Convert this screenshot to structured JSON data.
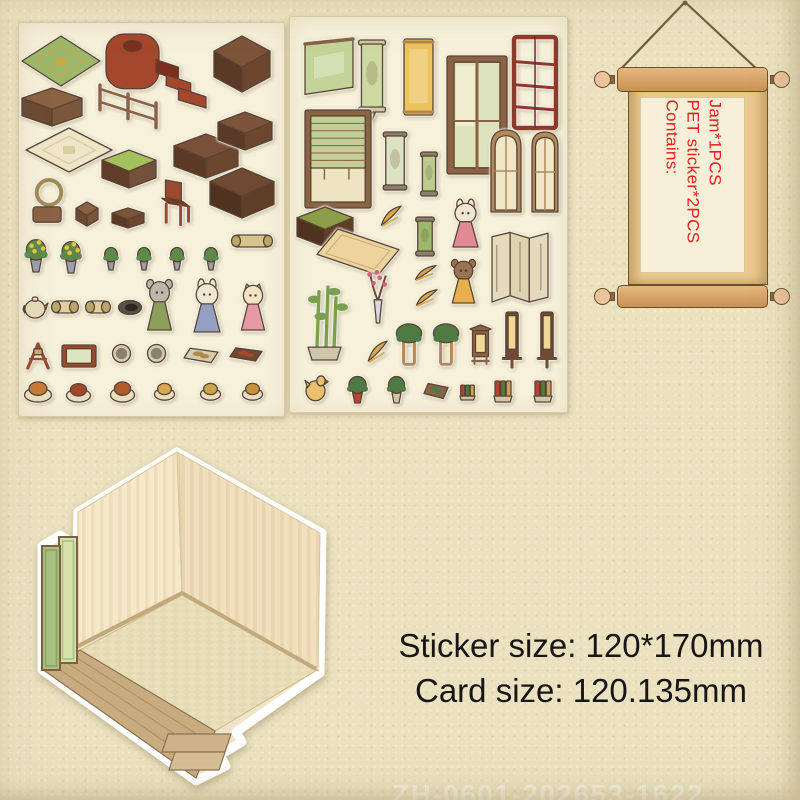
{
  "background": {
    "paper": "#ebe1bf",
    "sheet": "#f7f1da",
    "outline": "#5a4330"
  },
  "scroll": {
    "lines": [
      "Contains:",
      "PET sticker*2PCS",
      "Jam*1PCS"
    ],
    "text_color": "#e3201b",
    "rod_color": "#d8a76a",
    "body_color": "#eac88e",
    "panel_color": "#f7efd7"
  },
  "size_text": {
    "line1": "Sticker size: 120*170mm",
    "line2": "Card size: 120.135mm",
    "color": "#161616"
  },
  "watermark": "ZH-0601-202653-1622",
  "room_card": {
    "wall_color": "#f5e8cb",
    "floor_color": "#ebe0bd",
    "porch_color": "#c8ab7e",
    "screen_color": "#a9c083"
  },
  "sheets": [
    {
      "name": "sticker-sheet-1",
      "stickers": [
        {
          "n": "rug-green-diamond",
          "t": "rug",
          "x": 2,
          "y": 12,
          "w": 80,
          "h": 52,
          "c": [
            "#9cb86b",
            "#c8a84b"
          ]
        },
        {
          "n": "bed-stairs",
          "t": "bed",
          "x": 86,
          "y": 10,
          "w": 102,
          "h": 76,
          "c": [
            "#a5472c",
            "#7d2f1d"
          ]
        },
        {
          "n": "cabinet",
          "t": "box",
          "x": 194,
          "y": 12,
          "w": 58,
          "h": 58,
          "c": [
            "#7d543a",
            "#5a3a26",
            "#6d462e"
          ]
        },
        {
          "n": "wall-shelf",
          "t": "box",
          "x": 2,
          "y": 64,
          "w": 62,
          "h": 40,
          "c": [
            "#8a6244",
            "#6b4a32",
            "#7a563c"
          ]
        },
        {
          "n": "fence-railing",
          "t": "fence",
          "x": 78,
          "y": 52,
          "w": 62,
          "h": 56,
          "c": [
            "#8a6244"
          ]
        },
        {
          "n": "rug-cream-diamond",
          "t": "rug",
          "x": 6,
          "y": 104,
          "w": 88,
          "h": 46,
          "c": [
            "#efe6c8",
            "#d9cda4"
          ]
        },
        {
          "n": "bench-green-cushion",
          "t": "box",
          "x": 82,
          "y": 126,
          "w": 56,
          "h": 40,
          "c": [
            "#a2c05c",
            "#5f3d28",
            "#75503a"
          ]
        },
        {
          "n": "desk",
          "t": "box",
          "x": 154,
          "y": 110,
          "w": 66,
          "h": 46,
          "c": [
            "#7a5138",
            "#5a3a26",
            "#6d462e"
          ]
        },
        {
          "n": "tea-table",
          "t": "box",
          "x": 198,
          "y": 88,
          "w": 56,
          "h": 40,
          "c": [
            "#7d543a",
            "#5a3a26",
            "#6d462e"
          ]
        },
        {
          "n": "basket-chair",
          "t": "basket",
          "x": 12,
          "y": 156,
          "w": 36,
          "h": 48,
          "c": [
            "#a08a56",
            "#8a6244"
          ]
        },
        {
          "n": "stool",
          "t": "box",
          "x": 56,
          "y": 178,
          "w": 24,
          "h": 26,
          "c": [
            "#8a6244",
            "#6b4a32",
            "#7a563c"
          ]
        },
        {
          "n": "foot-stool",
          "t": "box",
          "x": 92,
          "y": 184,
          "w": 34,
          "h": 22,
          "c": [
            "#7d543a",
            "#5a3a26",
            "#6d462e"
          ]
        },
        {
          "n": "armchair",
          "t": "chair",
          "x": 140,
          "y": 156,
          "w": 36,
          "h": 48,
          "c": [
            "#9c4a2e",
            "#7d3a22"
          ]
        },
        {
          "n": "daybed-bench",
          "t": "box",
          "x": 190,
          "y": 144,
          "w": 66,
          "h": 52,
          "c": [
            "#6f4931",
            "#4f3320",
            "#5f3e27"
          ]
        },
        {
          "n": "rolled-mat",
          "t": "roll",
          "x": 212,
          "y": 208,
          "w": 42,
          "h": 20,
          "c": [
            "#d6c48e",
            "#b9a86b"
          ]
        },
        {
          "n": "flower-arrangement-1",
          "t": "flower",
          "x": 2,
          "y": 216,
          "w": 30,
          "h": 34,
          "c": [
            "#5d8a4a",
            "#98a0ad",
            "#e8c33c"
          ]
        },
        {
          "n": "flower-arrangement-2",
          "t": "flower",
          "x": 38,
          "y": 218,
          "w": 28,
          "h": 33,
          "c": [
            "#5d8a4a",
            "#98a0ad",
            "#e8c33c"
          ]
        },
        {
          "n": "potted-plant-1",
          "t": "plant",
          "x": 82,
          "y": 224,
          "w": 20,
          "h": 24,
          "c": [
            "#5d8a4a",
            "#9aa0a8"
          ]
        },
        {
          "n": "potted-plant-2",
          "t": "plant",
          "x": 115,
          "y": 224,
          "w": 20,
          "h": 24,
          "c": [
            "#5d8a4a",
            "#9aa0a8"
          ]
        },
        {
          "n": "potted-plant-3",
          "t": "plant",
          "x": 148,
          "y": 224,
          "w": 20,
          "h": 24,
          "c": [
            "#5d8a4a",
            "#9aa0a8"
          ]
        },
        {
          "n": "potted-plant-4",
          "t": "plant",
          "x": 182,
          "y": 224,
          "w": 20,
          "h": 24,
          "c": [
            "#5d8a4a",
            "#9aa0a8"
          ]
        },
        {
          "n": "censer",
          "t": "teapot",
          "x": 2,
          "y": 268,
          "w": 28,
          "h": 30,
          "c": [
            "#e5dabb",
            "#8a6244"
          ]
        },
        {
          "n": "scroll-bundle-1",
          "t": "roll",
          "x": 32,
          "y": 274,
          "w": 28,
          "h": 20,
          "c": [
            "#e3cf9c",
            "#b9a86b"
          ]
        },
        {
          "n": "scroll-bundle-2",
          "t": "roll",
          "x": 66,
          "y": 274,
          "w": 26,
          "h": 20,
          "c": [
            "#e3cf9c",
            "#b9a86b"
          ]
        },
        {
          "n": "ink-dish",
          "t": "inkstone",
          "x": 98,
          "y": 276,
          "w": 26,
          "h": 17,
          "c": [
            "#57504a",
            "#2e2822"
          ]
        },
        {
          "n": "mouse-figure",
          "t": "char-round",
          "x": 124,
          "y": 256,
          "w": 33,
          "h": 52,
          "c": [
            "#bdb7aa",
            "#8aa05c"
          ]
        },
        {
          "n": "rabbit-figure",
          "t": "char-long",
          "x": 170,
          "y": 258,
          "w": 36,
          "h": 52,
          "c": [
            "#f0e6d4",
            "#93a0c4"
          ]
        },
        {
          "n": "cat-figure",
          "t": "char-point",
          "x": 218,
          "y": 260,
          "w": 32,
          "h": 48,
          "c": [
            "#f2e3c4",
            "#e59aa4"
          ]
        },
        {
          "n": "wooden-stand",
          "t": "stand",
          "x": 4,
          "y": 318,
          "w": 30,
          "h": 30,
          "c": [
            "#9c4a2e",
            "#caa96f"
          ]
        },
        {
          "n": "framed-art",
          "t": "frame",
          "x": 42,
          "y": 320,
          "w": 36,
          "h": 26,
          "c": [
            "#9c4a2e",
            "#dce4c0"
          ]
        },
        {
          "n": "plate-1",
          "t": "plate",
          "x": 92,
          "y": 320,
          "w": 21,
          "h": 21,
          "c": [
            "#d5cbae",
            "#8a8070"
          ]
        },
        {
          "n": "plate-2",
          "t": "plate",
          "x": 127,
          "y": 320,
          "w": 21,
          "h": 21,
          "c": [
            "#d5cbae",
            "#8a8070"
          ]
        },
        {
          "n": "dim-sum-tray",
          "t": "tray",
          "x": 164,
          "y": 320,
          "w": 36,
          "h": 24,
          "c": [
            "#d5cbae",
            "#b08a4a"
          ]
        },
        {
          "n": "snack-tray",
          "t": "tray",
          "x": 210,
          "y": 320,
          "w": 34,
          "h": 22,
          "c": [
            "#6f4931",
            "#a5472c"
          ]
        },
        {
          "n": "dish-1",
          "t": "food",
          "x": 4,
          "y": 356,
          "w": 30,
          "h": 24,
          "c": [
            "#e8dfc2",
            "#c47a3a"
          ]
        },
        {
          "n": "dish-2",
          "t": "food",
          "x": 46,
          "y": 358,
          "w": 27,
          "h": 22,
          "c": [
            "#e8dfc2",
            "#a5472c"
          ]
        },
        {
          "n": "dish-3",
          "t": "food",
          "x": 90,
          "y": 356,
          "w": 27,
          "h": 24,
          "c": [
            "#e8dfc2",
            "#b05a2e"
          ]
        },
        {
          "n": "dish-4",
          "t": "food",
          "x": 134,
          "y": 358,
          "w": 23,
          "h": 20,
          "c": [
            "#e8dfc2",
            "#d8a94e"
          ]
        },
        {
          "n": "dish-5",
          "t": "food",
          "x": 180,
          "y": 358,
          "w": 23,
          "h": 20,
          "c": [
            "#e8dfc2",
            "#caa54b"
          ]
        },
        {
          "n": "dish-6",
          "t": "food",
          "x": 222,
          "y": 358,
          "w": 23,
          "h": 20,
          "c": [
            "#e8dfc2",
            "#c8913c"
          ]
        }
      ]
    },
    {
      "name": "sticker-sheet-2",
      "stickers": [
        {
          "n": "wall-flag-green",
          "t": "flag",
          "x": 14,
          "y": 21,
          "w": 50,
          "h": 60,
          "c": [
            "#8a6244",
            "#c2d498"
          ]
        },
        {
          "n": "wall-scroll-green",
          "t": "scrolltail",
          "x": 66,
          "y": 22,
          "w": 32,
          "h": 82,
          "c": [
            "#cfc5a8",
            "#cdd9a0"
          ]
        },
        {
          "n": "wall-banner-yellow",
          "t": "banner",
          "x": 113,
          "y": 19,
          "w": 31,
          "h": 82,
          "c": [
            "#b08a4a",
            "#ecc35f"
          ]
        },
        {
          "n": "window-curtains",
          "t": "window",
          "x": 156,
          "y": 38,
          "w": 62,
          "h": 120,
          "c": [
            "#8a6244",
            "#dde3bc",
            "#f6f0d8"
          ]
        },
        {
          "n": "display-shelf-red",
          "t": "shelfunit",
          "x": 223,
          "y": 16,
          "w": 44,
          "h": 96,
          "c": [
            "#8d3a2a",
            "#6f2b1d"
          ]
        },
        {
          "n": "window-blinds",
          "t": "blindwin",
          "x": 14,
          "y": 92,
          "w": 68,
          "h": 100,
          "c": [
            "#8a6244",
            "#c3cf96",
            "#ede4c2"
          ]
        },
        {
          "n": "hanging-scroll-art",
          "t": "scrollpic",
          "x": 91,
          "y": 114,
          "w": 28,
          "h": 62,
          "c": [
            "#8a8070",
            "#dce3c2"
          ]
        },
        {
          "n": "hanging-scroll-small",
          "t": "scrollpic",
          "x": 129,
          "y": 134,
          "w": 20,
          "h": 48,
          "c": [
            "#8a8070",
            "#b9cc8e"
          ]
        },
        {
          "n": "arched-door-1",
          "t": "door",
          "x": 200,
          "y": 112,
          "w": 32,
          "h": 84,
          "c": [
            "#b08a5a",
            "#f0e6c8"
          ]
        },
        {
          "n": "arched-door-2",
          "t": "door",
          "x": 241,
          "y": 114,
          "w": 28,
          "h": 82,
          "c": [
            "#b08a5a",
            "#f0e6c8"
          ]
        },
        {
          "n": "bench-low",
          "t": "box",
          "x": 6,
          "y": 189,
          "w": 58,
          "h": 42,
          "c": [
            "#8a9e4a",
            "#4f3320",
            "#5f3e27"
          ]
        },
        {
          "n": "leaf-spray-1",
          "t": "leaf",
          "x": 89,
          "y": 187,
          "w": 24,
          "h": 26,
          "c": [
            "#d8a94e"
          ]
        },
        {
          "n": "scroll-bamboo",
          "t": "scrollpic",
          "x": 124,
          "y": 199,
          "w": 22,
          "h": 43,
          "c": [
            "#8a8070",
            "#9cb86b"
          ]
        },
        {
          "n": "rabbit-girl-figure",
          "t": "char-long",
          "x": 158,
          "y": 184,
          "w": 35,
          "h": 47,
          "c": [
            "#f0e6d4",
            "#e08a96"
          ]
        },
        {
          "n": "floor-mat",
          "t": "mat",
          "x": 26,
          "y": 211,
          "w": 84,
          "h": 48,
          "c": [
            "#ecd49c"
          ]
        },
        {
          "n": "folding-screen",
          "t": "screen3",
          "x": 201,
          "y": 214,
          "w": 58,
          "h": 72,
          "c": [
            "#8a8070",
            "#e3dbbc"
          ]
        },
        {
          "n": "leaf-spray-2",
          "t": "leaf",
          "x": 123,
          "y": 247,
          "w": 25,
          "h": 19,
          "c": [
            "#d8a94e"
          ]
        },
        {
          "n": "bear-figure",
          "t": "char-round",
          "x": 158,
          "y": 242,
          "w": 31,
          "h": 45,
          "c": [
            "#9a7350",
            "#e8b04a"
          ]
        },
        {
          "n": "leaf-spray-3",
          "t": "leaf",
          "x": 124,
          "y": 271,
          "w": 25,
          "h": 21,
          "c": [
            "#d8a94e"
          ]
        },
        {
          "n": "plum-blossom-vase",
          "t": "vaseplum",
          "x": 74,
          "y": 252,
          "w": 28,
          "h": 55,
          "c": [
            "#d4d9e0",
            "#d4607a"
          ]
        },
        {
          "n": "bamboo-plant",
          "t": "bamboo",
          "x": 14,
          "y": 267,
          "w": 50,
          "h": 77,
          "c": [
            "#7aa04f",
            "#cfc5a8"
          ]
        },
        {
          "n": "leaf-spray-4",
          "t": "leaf",
          "x": 76,
          "y": 322,
          "w": 23,
          "h": 27,
          "c": [
            "#d8a94e"
          ]
        },
        {
          "n": "plant-stand-1",
          "t": "planterstand",
          "x": 104,
          "y": 306,
          "w": 30,
          "h": 43,
          "c": [
            "#4f7a43",
            "#b08a5a"
          ]
        },
        {
          "n": "plant-stand-2",
          "t": "planterstand",
          "x": 141,
          "y": 306,
          "w": 30,
          "h": 43,
          "c": [
            "#4f7a43",
            "#b08a5a"
          ]
        },
        {
          "n": "wooden-lantern",
          "t": "lanternwood",
          "x": 178,
          "y": 307,
          "w": 25,
          "h": 42,
          "c": [
            "#8a6244",
            "#f0d998"
          ]
        },
        {
          "n": "floor-lamp-1",
          "t": "lamp",
          "x": 211,
          "y": 294,
          "w": 22,
          "h": 58,
          "c": [
            "#6f4931",
            "#f0d998"
          ]
        },
        {
          "n": "floor-lamp-2",
          "t": "lamp",
          "x": 246,
          "y": 294,
          "w": 22,
          "h": 58,
          "c": [
            "#6f4931",
            "#f0d998"
          ]
        },
        {
          "n": "bird-figure",
          "t": "bird",
          "x": 14,
          "y": 354,
          "w": 25,
          "h": 33,
          "c": [
            "#e8c06e",
            "#c47a3a"
          ]
        },
        {
          "n": "potted-flower-red",
          "t": "plant",
          "x": 54,
          "y": 359,
          "w": 27,
          "h": 28,
          "c": [
            "#4f7a43",
            "#b5452e"
          ]
        },
        {
          "n": "potted-flower",
          "t": "plant",
          "x": 94,
          "y": 359,
          "w": 25,
          "h": 28,
          "c": [
            "#4f7a43",
            "#cfc5a8"
          ]
        },
        {
          "n": "planter-box",
          "t": "tray",
          "x": 133,
          "y": 361,
          "w": 26,
          "h": 25,
          "c": [
            "#8a6244",
            "#4f7a43"
          ]
        },
        {
          "n": "book-stack-small",
          "t": "books",
          "x": 169,
          "y": 366,
          "w": 17,
          "h": 18,
          "c": [
            "#cfc5a8"
          ]
        },
        {
          "n": "book-stack-1",
          "t": "books",
          "x": 203,
          "y": 361,
          "w": 20,
          "h": 25,
          "c": [
            "#cfc5a8"
          ]
        },
        {
          "n": "book-stack-2",
          "t": "books",
          "x": 243,
          "y": 361,
          "w": 20,
          "h": 25,
          "c": [
            "#cfc5a8"
          ]
        }
      ]
    }
  ]
}
